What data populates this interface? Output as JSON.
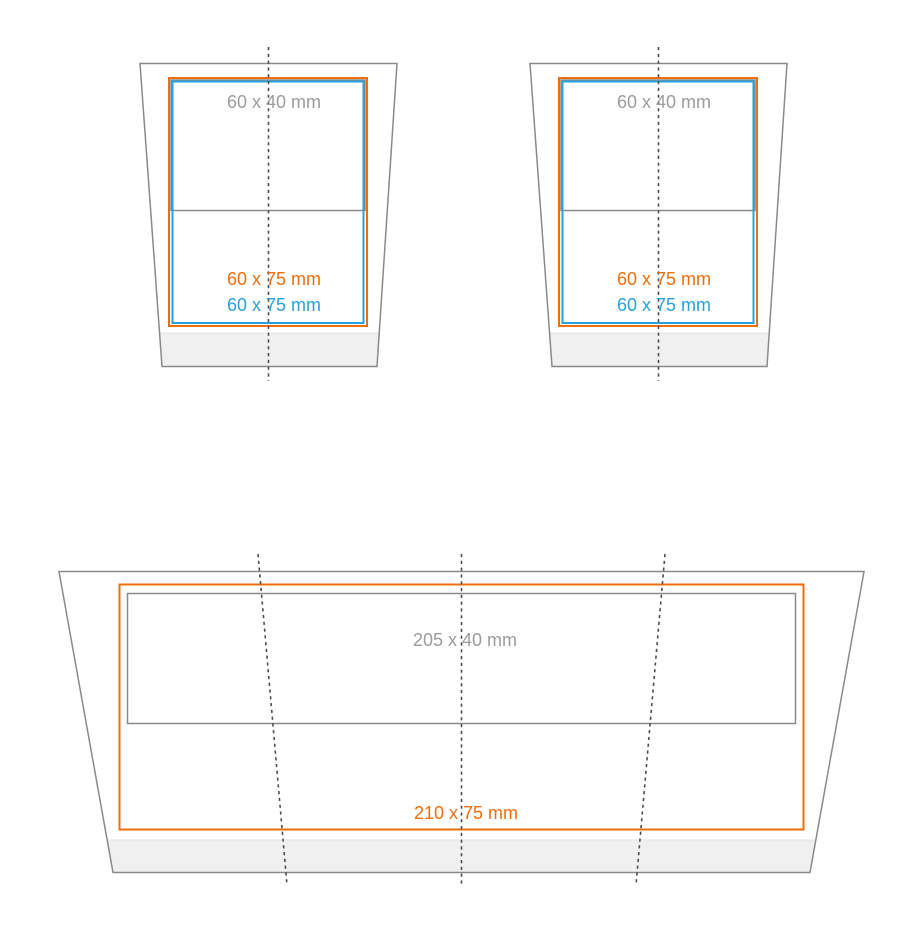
{
  "diagram": {
    "description": "Cup print area dimension diagram",
    "cups": [
      {
        "id": "top-left-cup",
        "print_area_label": "60 x 40 mm",
        "max_area_label_orange": "60 x 75 mm",
        "max_area_label_blue": "60 x 75 mm"
      },
      {
        "id": "top-right-cup",
        "print_area_label": "60 x 40 mm",
        "max_area_label_orange": "60 x 75 mm",
        "max_area_label_blue": "60 x 75 mm"
      },
      {
        "id": "bottom-wrap-cup",
        "print_area_label": "205 x 40 mm",
        "max_area_label_orange": "210 x 75 mm"
      }
    ]
  },
  "colors": {
    "orange": "#ee6e0d",
    "blue": "#27a2dc",
    "outline_gray": "#8a8a8a",
    "label_gray": "#9c9c9c",
    "dotted_gray": "#4d4d4d",
    "band_fill": "#f0f0f0",
    "background": "#ffffff"
  }
}
